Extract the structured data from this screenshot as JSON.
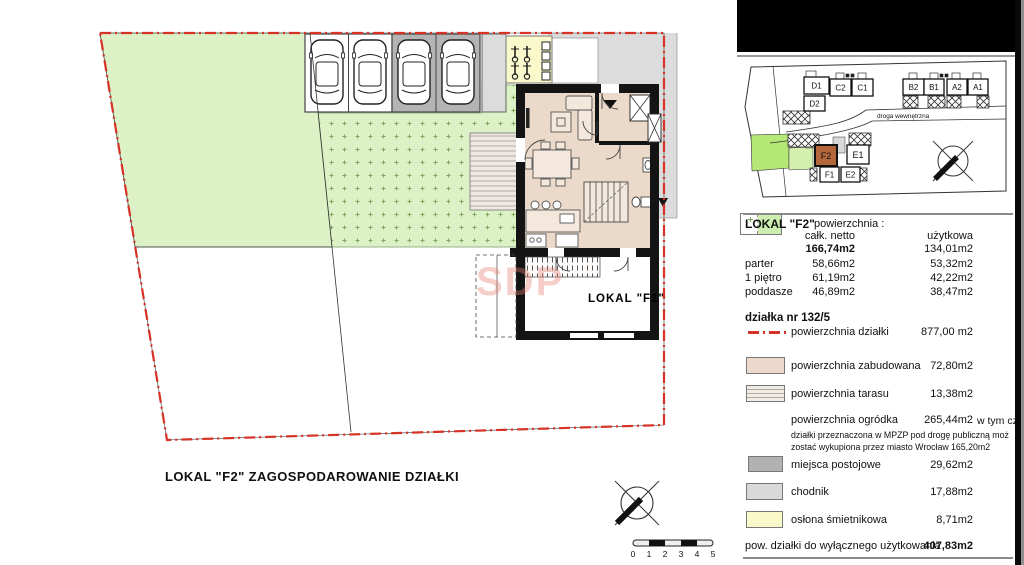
{
  "title": "LOKAL  \"F2\"  ZAGOSPODAROWANIE DZIAŁKI",
  "site_plan": {
    "f1_label": "LOKAL  \"F1\"",
    "watermark": "SDP",
    "scale_ticks": [
      "0",
      "1",
      "2",
      "3",
      "4",
      "5"
    ]
  },
  "minimap": {
    "road_label": "droga wewnętrzna",
    "highlighted_unit": "F2",
    "units": {
      "d1": "D1",
      "d2": "D2",
      "c2": "C2",
      "c1": "C1",
      "b2": "B2",
      "b1": "B1",
      "a2": "A2",
      "a1": "A1",
      "f2": "F2",
      "e1": "E1",
      "f1": "F1",
      "e2": "E2"
    }
  },
  "legend": {
    "header": {
      "lokal": "LOKAL  \"F2\"",
      "powierzchnia": "powierzchnia :",
      "col_netto": "całk. netto",
      "col_uzytkowa": "użytkowa",
      "total_netto": "166,74m2",
      "total_uzytkowa": "134,01m2"
    },
    "floors": [
      {
        "name": "parter",
        "netto": "58,66m2",
        "uzytkowa": "53,32m2"
      },
      {
        "name": "1 piętro",
        "netto": "61,19m2",
        "uzytkowa": "42,22m2"
      },
      {
        "name": "poddasze",
        "netto": "46,89m2",
        "uzytkowa": "38,47m2"
      }
    ],
    "dzialka_title": "działka nr  132/5",
    "boundary": {
      "label": "powierzchnia działki",
      "value": "877,00 m2"
    },
    "zabudowana": {
      "label": "powierzchnia zabudowana",
      "value": "72,80m2"
    },
    "tarasu": {
      "label": "powierzchnia tarasu",
      "value": "13,38m2"
    },
    "ogrodka": {
      "label": "powierzchnia ogródka",
      "value": "265,44m2",
      "note_inline": "w tym cz",
      "note_line2": "działki przeznaczona w MPZP pod drogę publiczną moż",
      "note_line3": "zostać wykupiona przez miasto Wrocław",
      "note_line3_value": "165,20m2"
    },
    "miejsca": {
      "label": "miejsca postojowe",
      "value": "29,62m2"
    },
    "chodnik": {
      "label": "chodnik",
      "value": "17,88m2"
    },
    "oslona": {
      "label": "osłona śmietnikowa",
      "value": "8,71m2"
    },
    "footer": {
      "label": "pow. działki do wyłącznego użytkowania",
      "value": "407,83m2"
    }
  },
  "colors": {
    "boundary_red": "#d63226",
    "lawn_green": "#ddf1c6",
    "built_beige": "#ecd9cb",
    "parking_gray": "#b4b4b4",
    "sidewalk_gray": "#dcdcdc",
    "bin_yellow": "#f9f9cc",
    "minimap_highlight": "#b4673a"
  }
}
